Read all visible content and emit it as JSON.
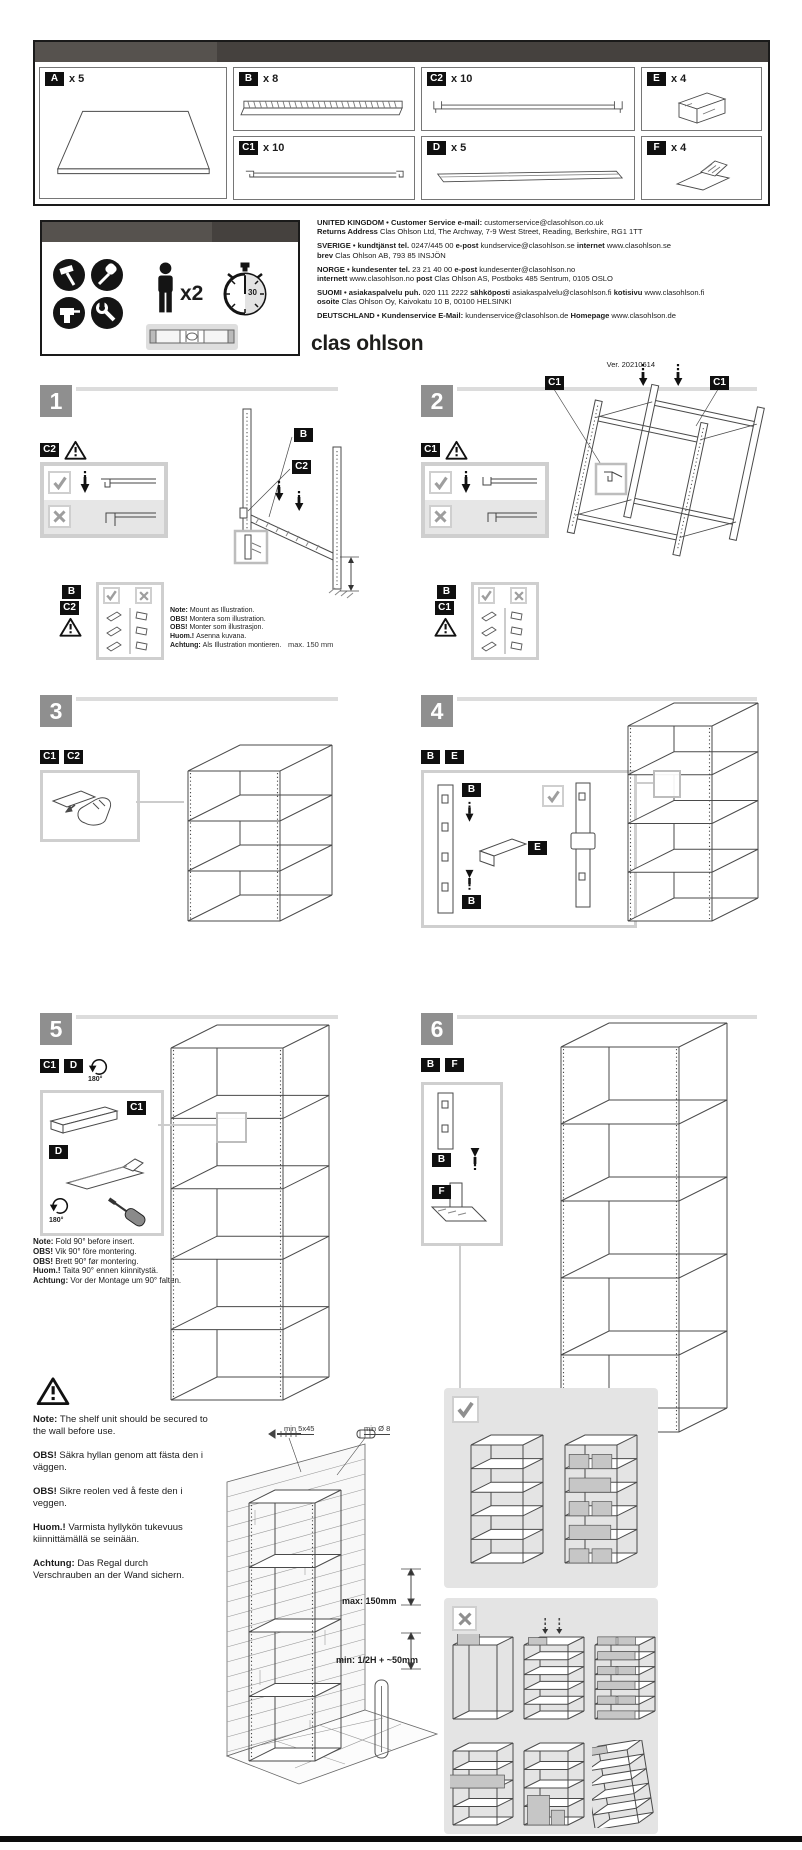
{
  "doc": {
    "brand_logo": "clas ohlson",
    "version": "Ver. 20210614"
  },
  "parts": {
    "a": {
      "id": "A",
      "qty": "x 5"
    },
    "b": {
      "id": "B",
      "qty": "x 8"
    },
    "c2": {
      "id": "C2",
      "qty": "x 10"
    },
    "c1": {
      "id": "C1",
      "qty": "x 10"
    },
    "d": {
      "id": "D",
      "qty": "x 5"
    },
    "e": {
      "id": "E",
      "qty": "x 4"
    },
    "f": {
      "id": "F",
      "qty": "x 4"
    }
  },
  "tools": {
    "persons_label": "x2",
    "timer_label": "30"
  },
  "contacts": {
    "uk1": [
      {
        "b": "UNITED KINGDOM • Customer Service"
      },
      {
        "b": "e-mail:"
      },
      {
        "t": "customerservice@clasohlson.co.uk"
      }
    ],
    "uk2": [
      {
        "b": "Returns Address"
      },
      {
        "t": "Clas Ohlson Ltd, The Archway, 7-9 West Street, Reading, Berkshire, RG1 1TT"
      }
    ],
    "se1": [
      {
        "b": "SVERIGE • kundtjänst"
      },
      {
        "b": "tel."
      },
      {
        "t": "0247/445 00"
      },
      {
        "b": "e-post"
      },
      {
        "t": "kundservice@clasohlson.se"
      },
      {
        "b": "internet"
      },
      {
        "t": "www.clasohlson.se"
      }
    ],
    "se2": [
      {
        "b": "brev"
      },
      {
        "t": "Clas Ohlson AB, 793 85 INSJÖN"
      }
    ],
    "no1": [
      {
        "b": "NORGE • kundesenter"
      },
      {
        "b": "tel."
      },
      {
        "t": "23 21 40 00"
      },
      {
        "b": "e-post"
      },
      {
        "t": "kundesenter@clasohlson.no"
      }
    ],
    "no2": [
      {
        "b": "internett"
      },
      {
        "t": "www.clasohlson.no"
      },
      {
        "b": "post"
      },
      {
        "t": "Clas Ohlson AS, Postboks 485 Sentrum, 0105 OSLO"
      }
    ],
    "fi1": [
      {
        "b": "SUOMI • asiakaspalvelu"
      },
      {
        "b": "puh."
      },
      {
        "t": "020 111 2222"
      },
      {
        "b": "sähköposti"
      },
      {
        "t": "asiakaspalvelu@clasohlson.fi"
      },
      {
        "b": "kotisivu"
      },
      {
        "t": "www.clasohlson.fi"
      }
    ],
    "fi2": [
      {
        "b": "osoite"
      },
      {
        "t": "Clas Ohlson Oy, Kaivokatu 10 B, 00100 HELSINKI"
      }
    ],
    "de1": [
      {
        "b": "DEUTSCHLAND • Kundenservice"
      },
      {
        "b": "E-Mail:"
      },
      {
        "t": "kundenservice@clasohlson.de"
      },
      {
        "b": "Homepage"
      },
      {
        "t": "www.clasohlson.de"
      }
    ]
  },
  "steps": {
    "s1": {
      "num": "1",
      "label_c2": "C2",
      "callout_b": "B",
      "callout_c2": "C2",
      "det_b": "B",
      "det_c2": "C2",
      "dim": "max. 150 mm",
      "notes": [
        [
          {
            "b": "Note:"
          },
          {
            "t": "Mount as Illustration."
          }
        ],
        [
          {
            "b": "OBS!"
          },
          {
            "t": "Montera som illustration."
          }
        ],
        [
          {
            "b": "OBS!"
          },
          {
            "t": "Monter som illustrasjon."
          }
        ],
        [
          {
            "b": "Huom.!"
          },
          {
            "t": "Asenna kuvana."
          }
        ],
        [
          {
            "b": "Achtung:"
          },
          {
            "t": "Als Illustration montieren."
          }
        ]
      ]
    },
    "s2": {
      "num": "2",
      "label_c1": "C1",
      "callout_c1a": "C1",
      "callout_c1b": "C1",
      "det_b": "B",
      "det_c1": "C1"
    },
    "s3": {
      "num": "3",
      "label_c1": "C1",
      "label_c2": "C2"
    },
    "s4": {
      "num": "4",
      "label_b": "B",
      "label_e": "E",
      "det_b_top": "B",
      "det_e": "E",
      "det_b_bot": "B"
    },
    "s5": {
      "num": "5",
      "label_c1": "C1",
      "label_d": "D",
      "rotate_label": "180°",
      "det_c1": "C1",
      "det_d": "D",
      "det_rotate_label": "180°",
      "notes": [
        [
          {
            "b": "Note:"
          },
          {
            "t": "Fold 90° before insert."
          }
        ],
        [
          {
            "b": "OBS!"
          },
          {
            "t": "Vik 90° före montering."
          }
        ],
        [
          {
            "b": "OBS!"
          },
          {
            "t": "Brett 90° før montering."
          }
        ],
        [
          {
            "b": "Huom.!"
          },
          {
            "t": "Taita 90° ennen kiinnitystä."
          }
        ],
        [
          {
            "b": "Achtung:"
          },
          {
            "t": "Vor der Montage um 90° falten."
          }
        ]
      ]
    },
    "s6": {
      "num": "6",
      "label_b": "B",
      "label_f": "F",
      "det_b": "B",
      "det_f": "F"
    }
  },
  "wall": {
    "screw_label": "min 5x45",
    "plug_label": "min Ø 8",
    "dim_max": "max: 150mm",
    "dim_min": "min: 1/2H + ~50mm",
    "notes": [
      [
        {
          "b": "Note:"
        },
        {
          "t": "The shelf unit should be secured to the wall before use."
        }
      ],
      [
        {
          "b": "OBS!"
        },
        {
          "t": "Säkra hyllan genom att fästa den i väggen."
        }
      ],
      [
        {
          "b": "OBS!"
        },
        {
          "t": "Sikre reolen ved å feste den i veggen."
        }
      ],
      [
        {
          "b": "Huom.!"
        },
        {
          "t": "Varmista hyllykön tukevuus kiinnittämällä se seinään."
        }
      ],
      [
        {
          "b": "Achtung:"
        },
        {
          "t": "Das Regal durch Verschrauben an der Wand sichern."
        }
      ]
    ]
  }
}
